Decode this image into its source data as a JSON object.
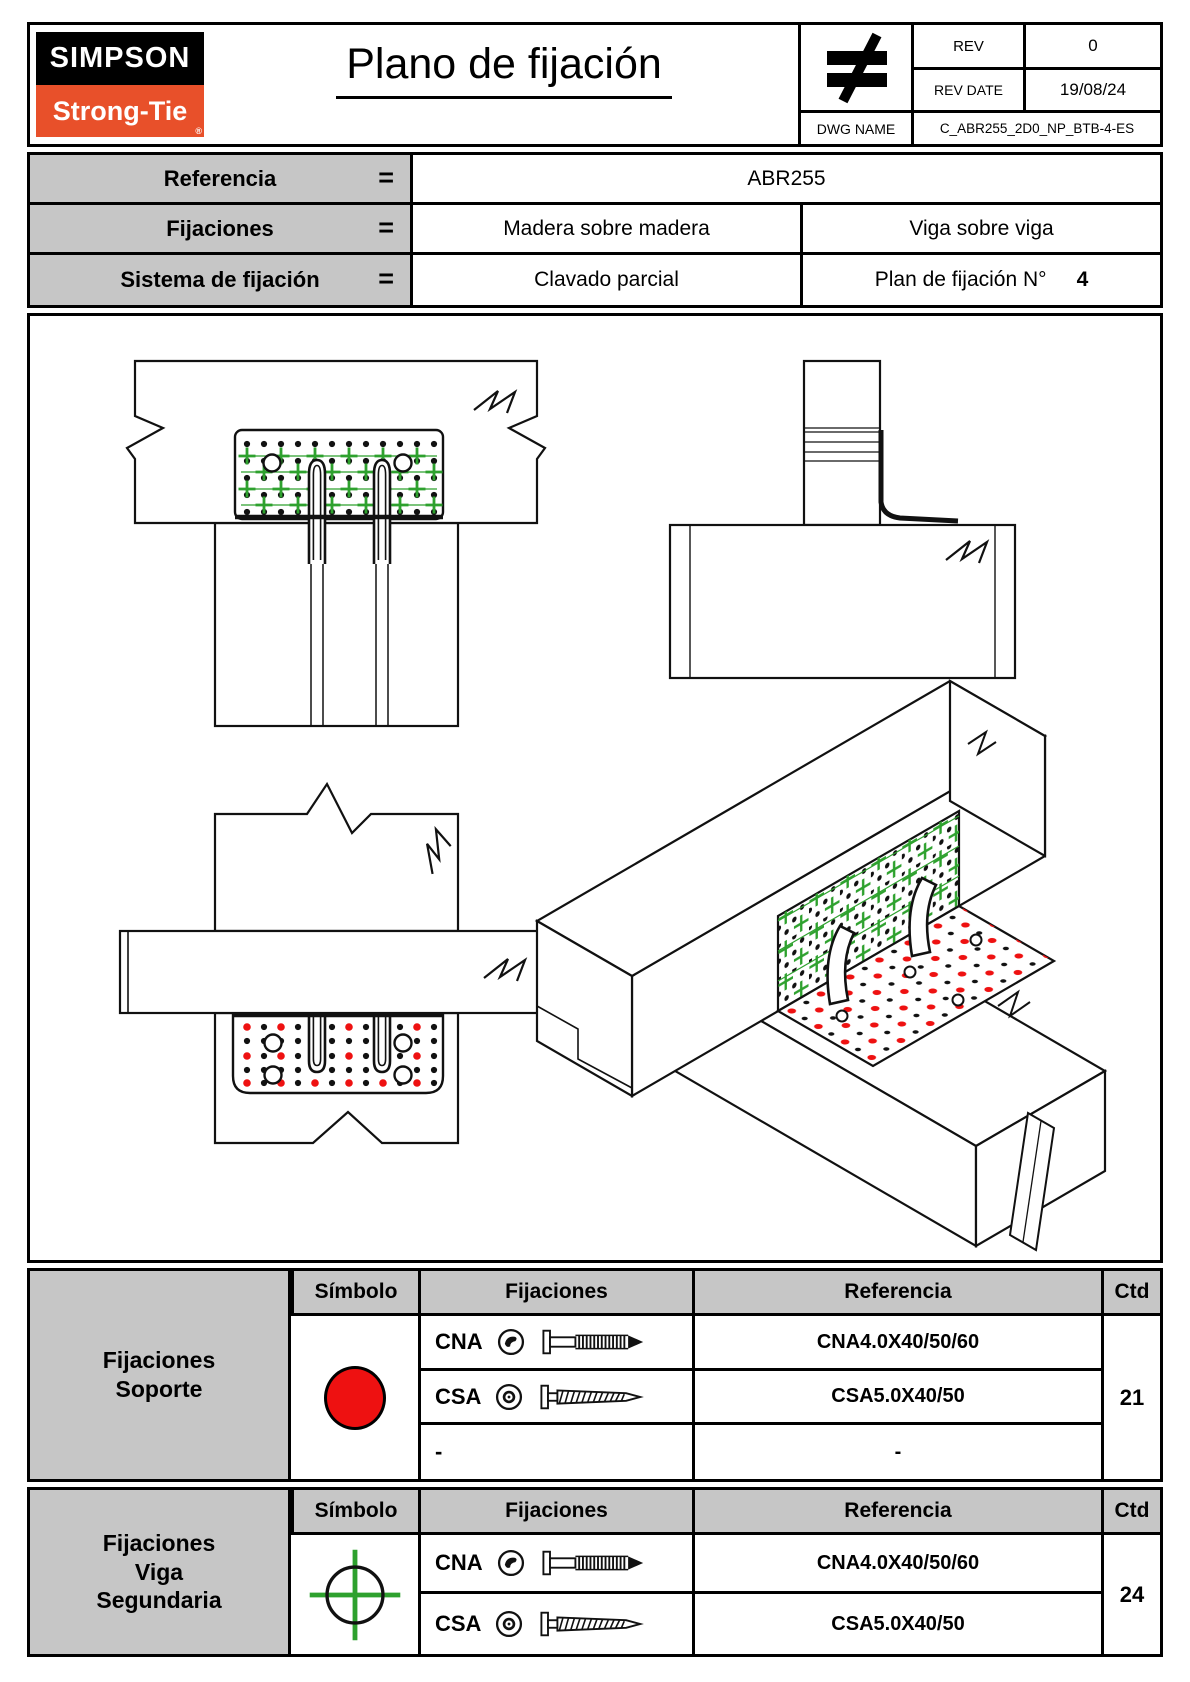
{
  "colors": {
    "accent_red": "#ee1111",
    "accent_green": "#2ea12e",
    "logo_orange": "#e8502a",
    "header_gray": "#c6c6c6"
  },
  "header": {
    "logo_top": "SIMPSON",
    "logo_bottom": "Strong-Tie",
    "logo_reg": "®",
    "title": "Plano de fijación",
    "rev_label": "REV",
    "rev_value": "0",
    "rev_date_label": "REV DATE",
    "rev_date_value": "19/08/24",
    "dwg_label": "DWG NAME",
    "dwg_value": "C_ABR255_2D0_NP_BTB-4-ES"
  },
  "info": {
    "row1": {
      "label": "Referencia",
      "eq": "=",
      "value": "ABR255"
    },
    "row2": {
      "label": "Fijaciones",
      "eq": "=",
      "value_a": "Madera sobre madera",
      "value_b": "Viga sobre viga"
    },
    "row3": {
      "label": "Sistema de fijación",
      "eq": "=",
      "value_a": "Clavado parcial",
      "value_b": "Plan de fijación N°",
      "value_b_num": "4"
    }
  },
  "legend": {
    "col_symbol": "Símbolo",
    "col_fixings": "Fijaciones",
    "col_reference": "Referencia",
    "col_qty": "Ctd",
    "support": {
      "group_line1": "Fijaciones",
      "group_line2": "Soporte",
      "row1_code": "CNA",
      "row1_ref": "CNA4.0X40/50/60",
      "row2_code": "CSA",
      "row2_ref": "CSA5.0X40/50",
      "row3_code": "-",
      "row3_ref": "-",
      "qty": "21"
    },
    "secondary": {
      "group_line1": "Fijaciones",
      "group_line2": "Viga",
      "group_line3": "Segundaria",
      "row1_code": "CNA",
      "row1_ref": "CNA4.0X40/50/60",
      "row2_code": "CSA",
      "row2_ref": "CSA5.0X40/50",
      "qty": "24"
    }
  }
}
